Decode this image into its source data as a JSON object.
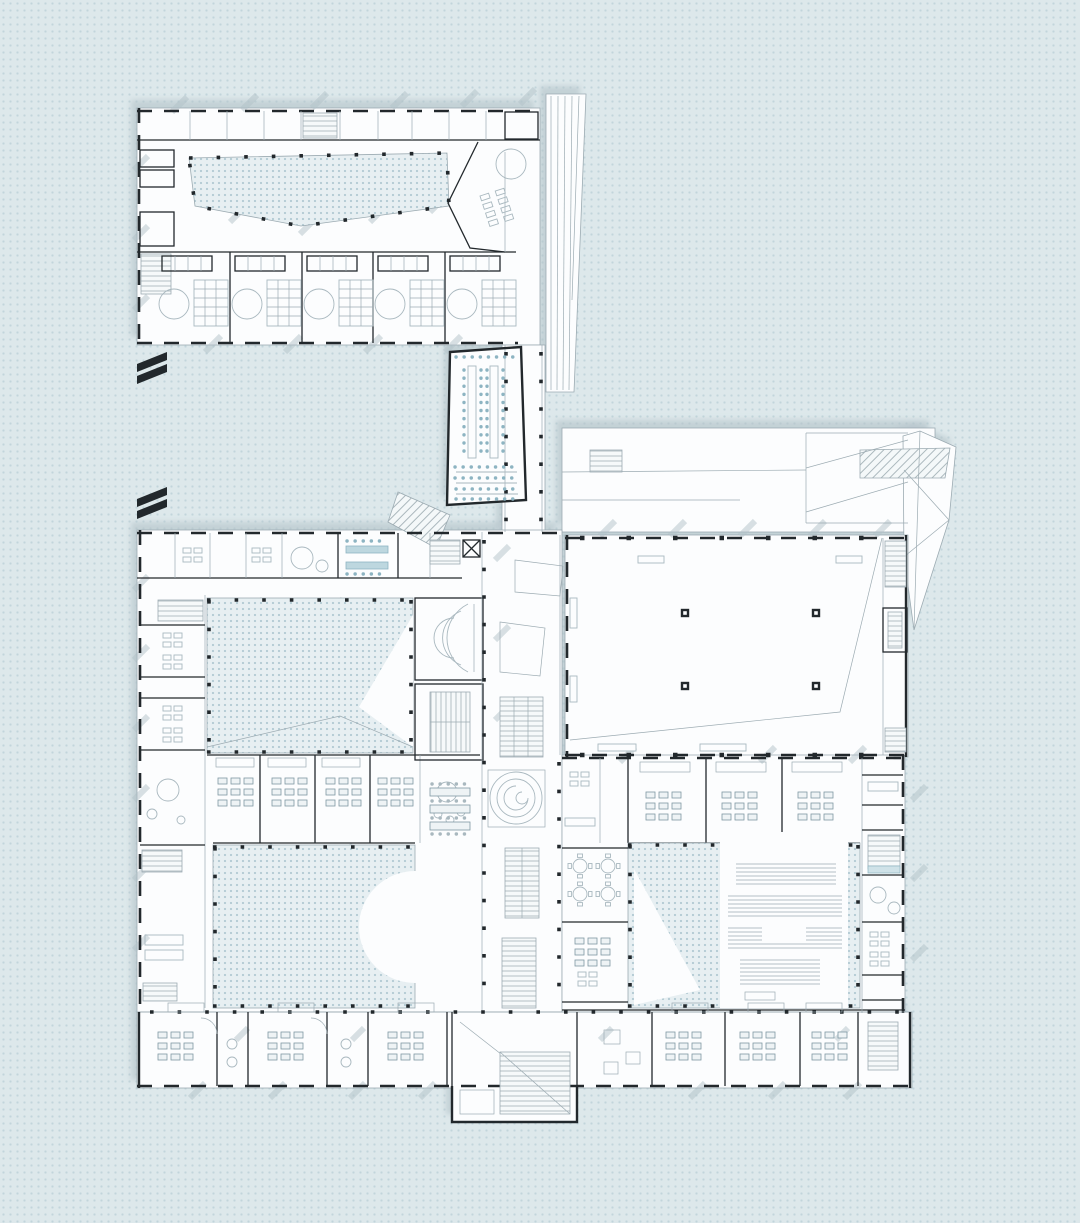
{
  "page": {
    "title": "architectural-floor-plan",
    "level": "ground-floor-plan",
    "visible_text": []
  },
  "canvas": {
    "width": 1080,
    "height": 1223
  },
  "colors": {
    "bg": "#dde8eb",
    "bgDot": "#c2d5db",
    "paper": "#fcfdfe",
    "paperLine": "#9cabb2",
    "wall": "#22282c",
    "courtyard": "#e7eff2",
    "courtyardDot": "#b4cbd4",
    "shadow": "#b2c1c8",
    "furniture": "#a9b8bf",
    "furnitureBlue": "#8db4c2",
    "desk": "#7e98a2",
    "hatch": "#a3b1b7",
    "mark": "#22282c"
  },
  "plan": {
    "features": [
      "kindergarten-wing",
      "entry-courtyard",
      "kindergarten-classroom-units",
      "auditorium-seating",
      "link-corridor",
      "roof-terrace",
      "sports-hall",
      "west-classroom-wing",
      "central-courtyard",
      "garden-courtyard",
      "library-courtyard",
      "library-shelving",
      "spiral-ramp",
      "stair-cores",
      "south-classroom-row",
      "east-classroom-wing",
      "entrance-stair-hall",
      "drawing-break-marks"
    ]
  }
}
